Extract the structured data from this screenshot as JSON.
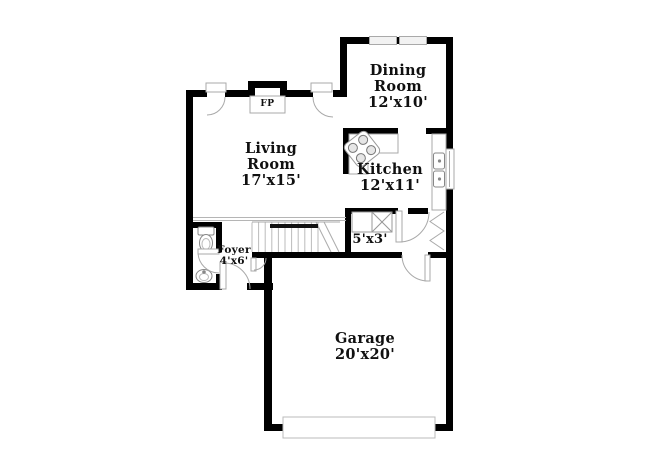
{
  "title": "Floor plan",
  "colors": {
    "wall": "#000000",
    "thin_line": "#a9a9a9",
    "fixture_line": "#888888",
    "text": "#101010",
    "background": "#ffffff"
  },
  "rooms": {
    "dining": {
      "name": "Dining Room",
      "dims": "12'x10'"
    },
    "living": {
      "name": "Living Room",
      "dims": "17'x15'"
    },
    "kitchen": {
      "name": "Kitchen",
      "dims": "12'x11'"
    },
    "foyer": {
      "name": "Foyer",
      "dims": "4'x6'"
    },
    "pantry": {
      "dims": "5'x3'"
    },
    "garage": {
      "name": "Garage",
      "dims": "20'x20'"
    }
  },
  "fireplace": {
    "abbr": "FP"
  },
  "fixtures": [
    "fireplace",
    "stairs",
    "handrail",
    "toilet",
    "pedestal-sink",
    "range-cooktop",
    "kitchen-counter",
    "double-sink",
    "pantry-shelves",
    "bifold-closet-doors",
    "garage-door",
    "window",
    "door-swing"
  ]
}
